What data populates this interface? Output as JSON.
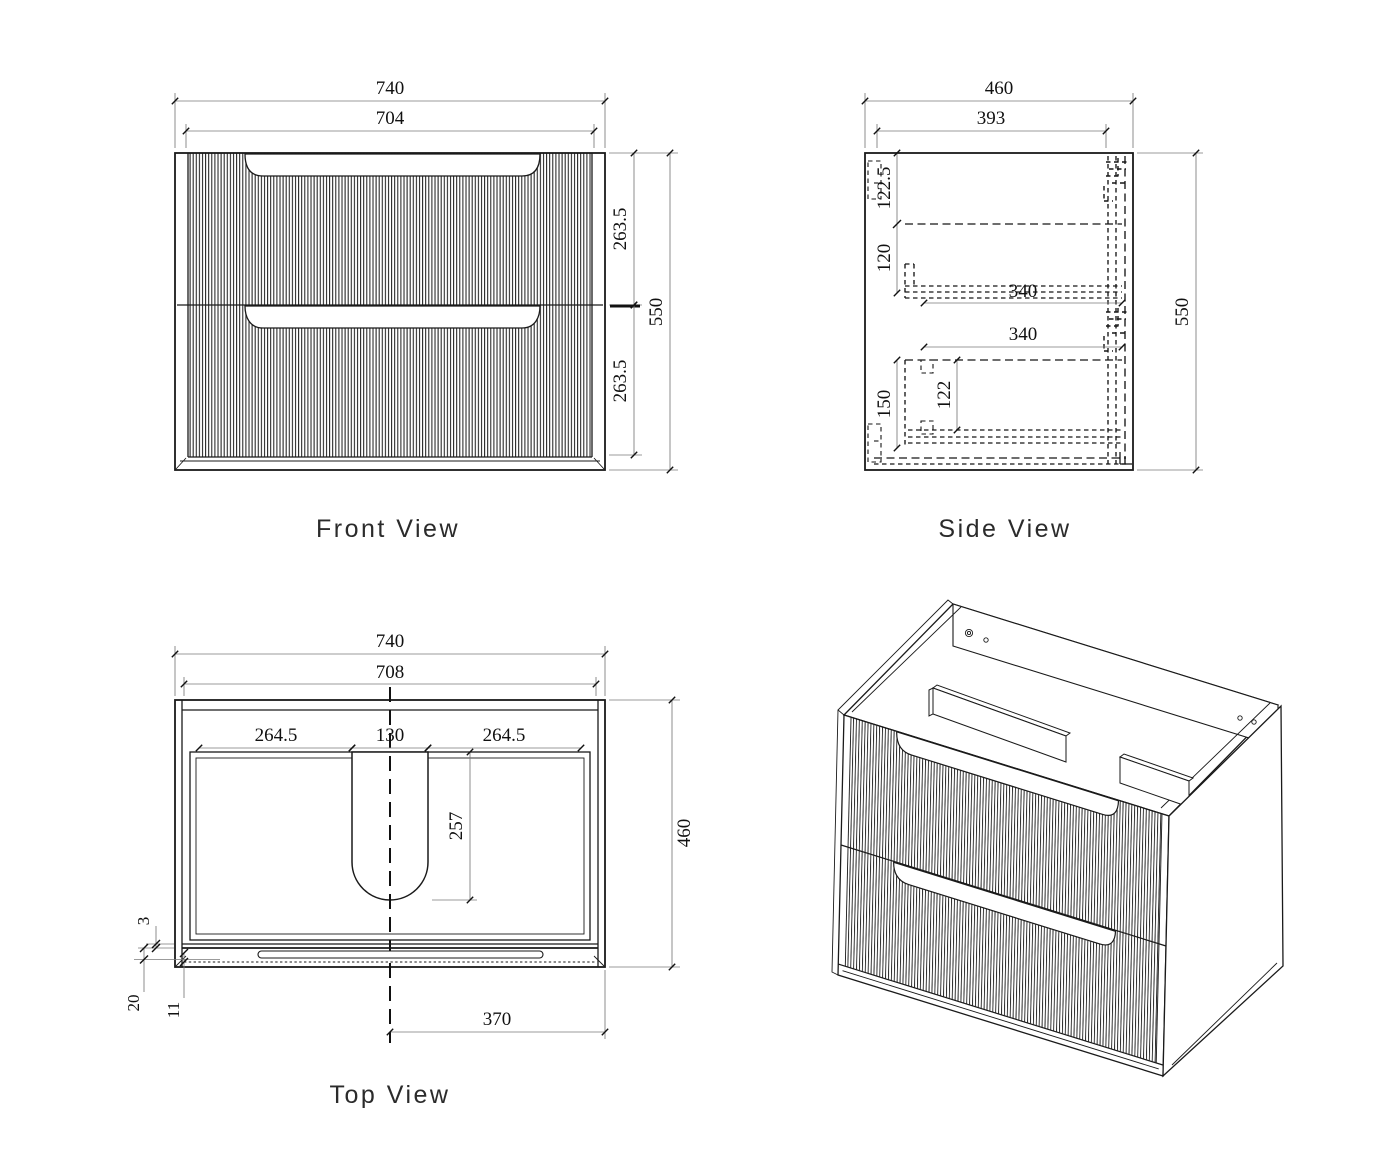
{
  "sheet": {
    "background": "#ffffff",
    "line_color": "#1a1a1a"
  },
  "views": {
    "front": {
      "label": "Front View",
      "dims": {
        "overall_width": "740",
        "drawer_front_width": "704",
        "top_drawer_height": "263.5",
        "bottom_drawer_height": "263.5",
        "overall_height": "550"
      }
    },
    "side": {
      "label": "Side View",
      "dims": {
        "overall_depth": "460",
        "internal_depth": "393",
        "top_to_drawer_box": "122.5",
        "top_drawer_box_height": "120",
        "top_drawer_box_depth": "340",
        "bottom_drawer_box_depth": "340",
        "bottom_drawer_box_height": "150",
        "bottom_drawer_inner_height": "122",
        "overall_height": "550"
      }
    },
    "top": {
      "label": "Top View",
      "dims": {
        "overall_width": "740",
        "internal_width": "708",
        "cutout_left_offset": "264.5",
        "cutout_width": "130",
        "cutout_right_offset": "264.5",
        "cutout_depth": "257",
        "overall_depth": "460",
        "front_gap": "3",
        "front_panel_thickness": "20",
        "front_edge_inset": "11",
        "cutout_center_to_edge": "370"
      }
    },
    "isometric": {
      "description": "3D view of wall-hung two-drawer fluted vanity cabinet"
    }
  }
}
